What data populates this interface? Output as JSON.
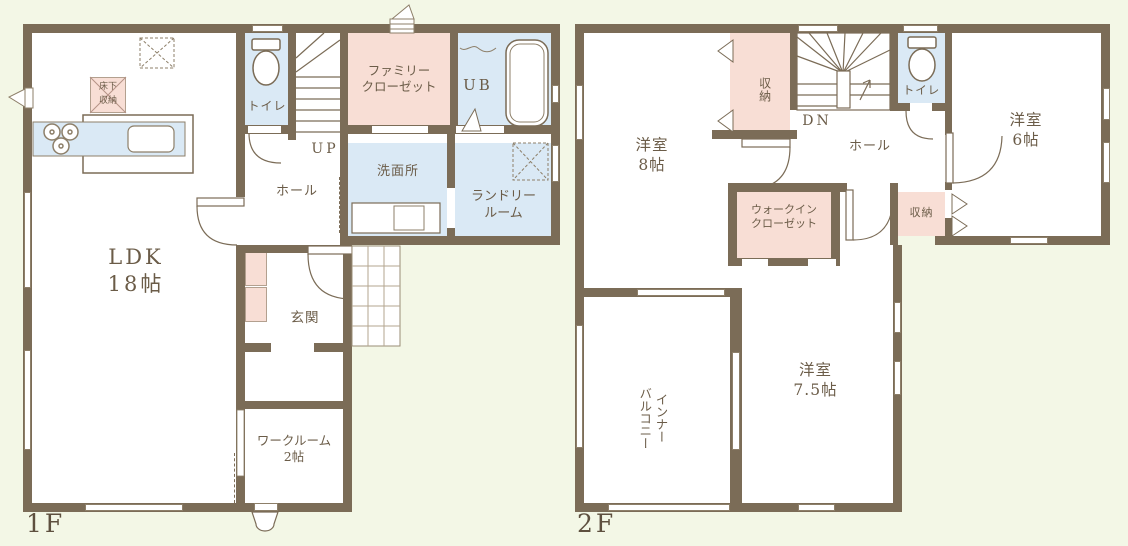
{
  "colors": {
    "background": "#f3f7e6",
    "wall": "#7b6c57",
    "room_white": "#ffffff",
    "closet_pink": "#f8ded5",
    "water_blue": "#dae9f5",
    "text": "#6b5c48"
  },
  "floor1": {
    "label": "1F",
    "rooms": {
      "ldk": "LDK\n18帖",
      "hall": "ホール",
      "toilet": "トイレ",
      "stairs_up": "UP",
      "family_closet": "ファミリー\nクローゼット",
      "unit_bath": "UB",
      "washroom": "洗面所",
      "laundry": "ランドリー\nルーム",
      "entrance": "玄関",
      "workroom": "ワークルーム\n2帖",
      "underfloor_storage": "床下\n収納"
    }
  },
  "floor2": {
    "label": "2F",
    "rooms": {
      "bedroom8": "洋室\n8帖",
      "storage_left": "収納",
      "stairs_down": "DN",
      "toilet": "トイレ",
      "hall": "ホール",
      "bedroom6": "洋室\n6帖",
      "walk_in_closet": "ウォークイン\nクローゼット",
      "storage_right": "収納",
      "inner_balcony": "インナー\nバルコニー",
      "bedroom75": "洋室\n7.5帖"
    }
  }
}
